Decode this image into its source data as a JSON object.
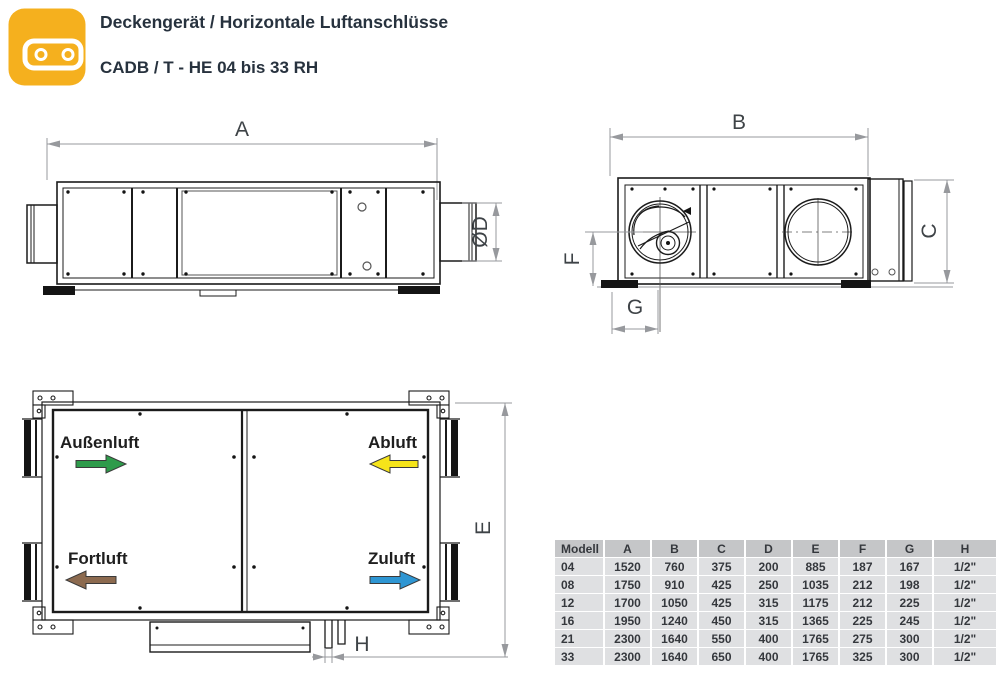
{
  "header": {
    "title": "Deckengerät / Horizontale Luftanschlüsse",
    "subtitle": "CADB / T - HE 04 bis 33 RH",
    "icon": {
      "name": "ceiling-unit-icon",
      "color": "#F5B01E"
    }
  },
  "dims": {
    "a": "A",
    "b": "B",
    "c": "C",
    "d": "ØD",
    "e": "E",
    "f": "F",
    "g": "G",
    "h": "H"
  },
  "flows": [
    {
      "label": "Außenluft",
      "color": "#2E9B4B",
      "direction": "right"
    },
    {
      "label": "Abluft",
      "color": "#F5E41A",
      "direction": "left"
    },
    {
      "label": "Fortluft",
      "color": "#8C6A4F",
      "direction": "left"
    },
    {
      "label": "Zuluft",
      "color": "#2E96D3",
      "direction": "right"
    }
  ],
  "table": {
    "columns": [
      "Modell",
      "A",
      "B",
      "C",
      "D",
      "E",
      "F",
      "G",
      "H"
    ],
    "rows": [
      [
        "04",
        "1520",
        "760",
        "375",
        "200",
        "885",
        "187",
        "167",
        "1/2\""
      ],
      [
        "08",
        "1750",
        "910",
        "425",
        "250",
        "1035",
        "212",
        "198",
        "1/2\""
      ],
      [
        "12",
        "1700",
        "1050",
        "425",
        "315",
        "1175",
        "212",
        "225",
        "1/2\""
      ],
      [
        "16",
        "1950",
        "1240",
        "450",
        "315",
        "1365",
        "225",
        "245",
        "1/2\""
      ],
      [
        "21",
        "2300",
        "1640",
        "550",
        "400",
        "1765",
        "275",
        "300",
        "1/2\""
      ],
      [
        "33",
        "2300",
        "1640",
        "650",
        "400",
        "1765",
        "325",
        "300",
        "1/2\""
      ]
    ]
  }
}
